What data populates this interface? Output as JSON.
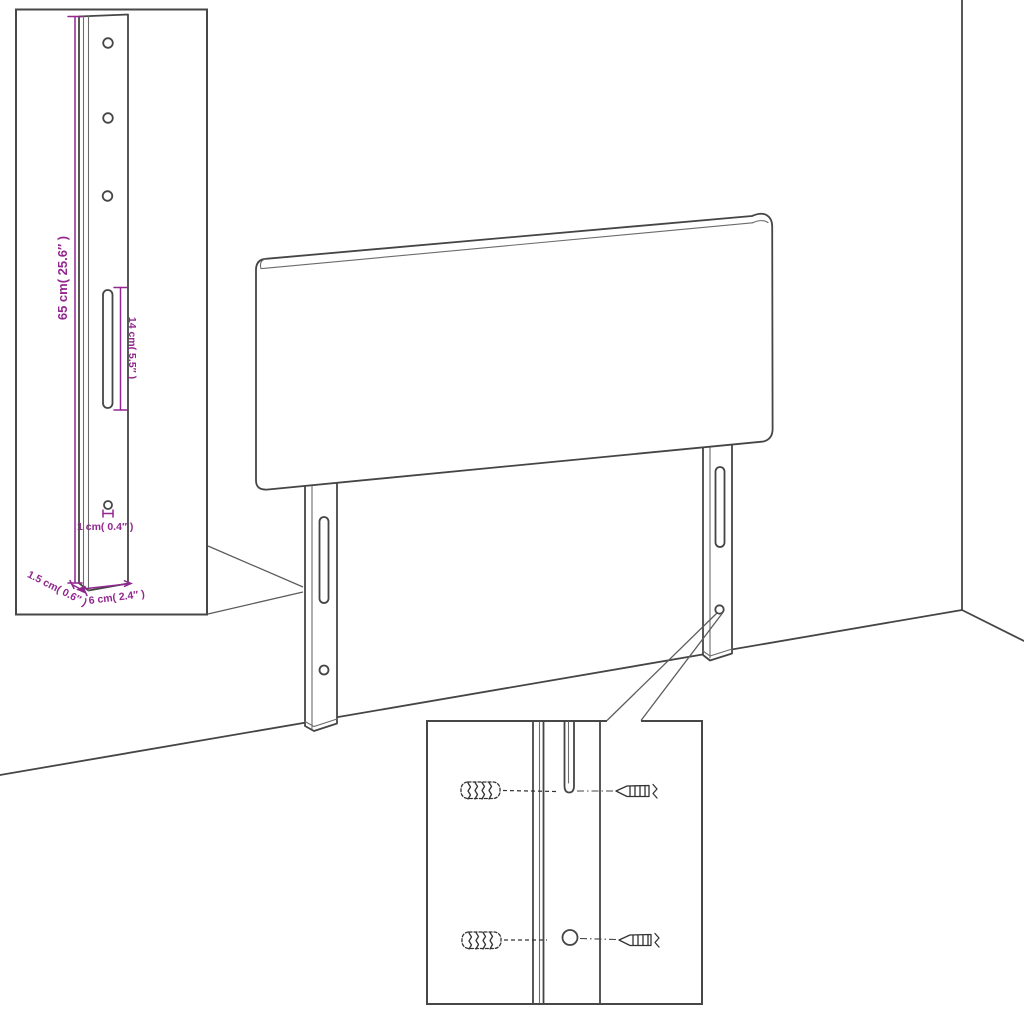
{
  "dimension_labels": {
    "height": "65 cm( 25.6″ )",
    "slot_length": "14 cm( 5.5″ )",
    "hole_diameter": "1 cm( 0.4″ )",
    "thickness": "1.5 cm( 0.6″ )",
    "width": "6 cm( 2.4″ )"
  },
  "colors": {
    "dimension_accent": "#92278F",
    "line_art": "#454545",
    "background": "#ffffff"
  }
}
